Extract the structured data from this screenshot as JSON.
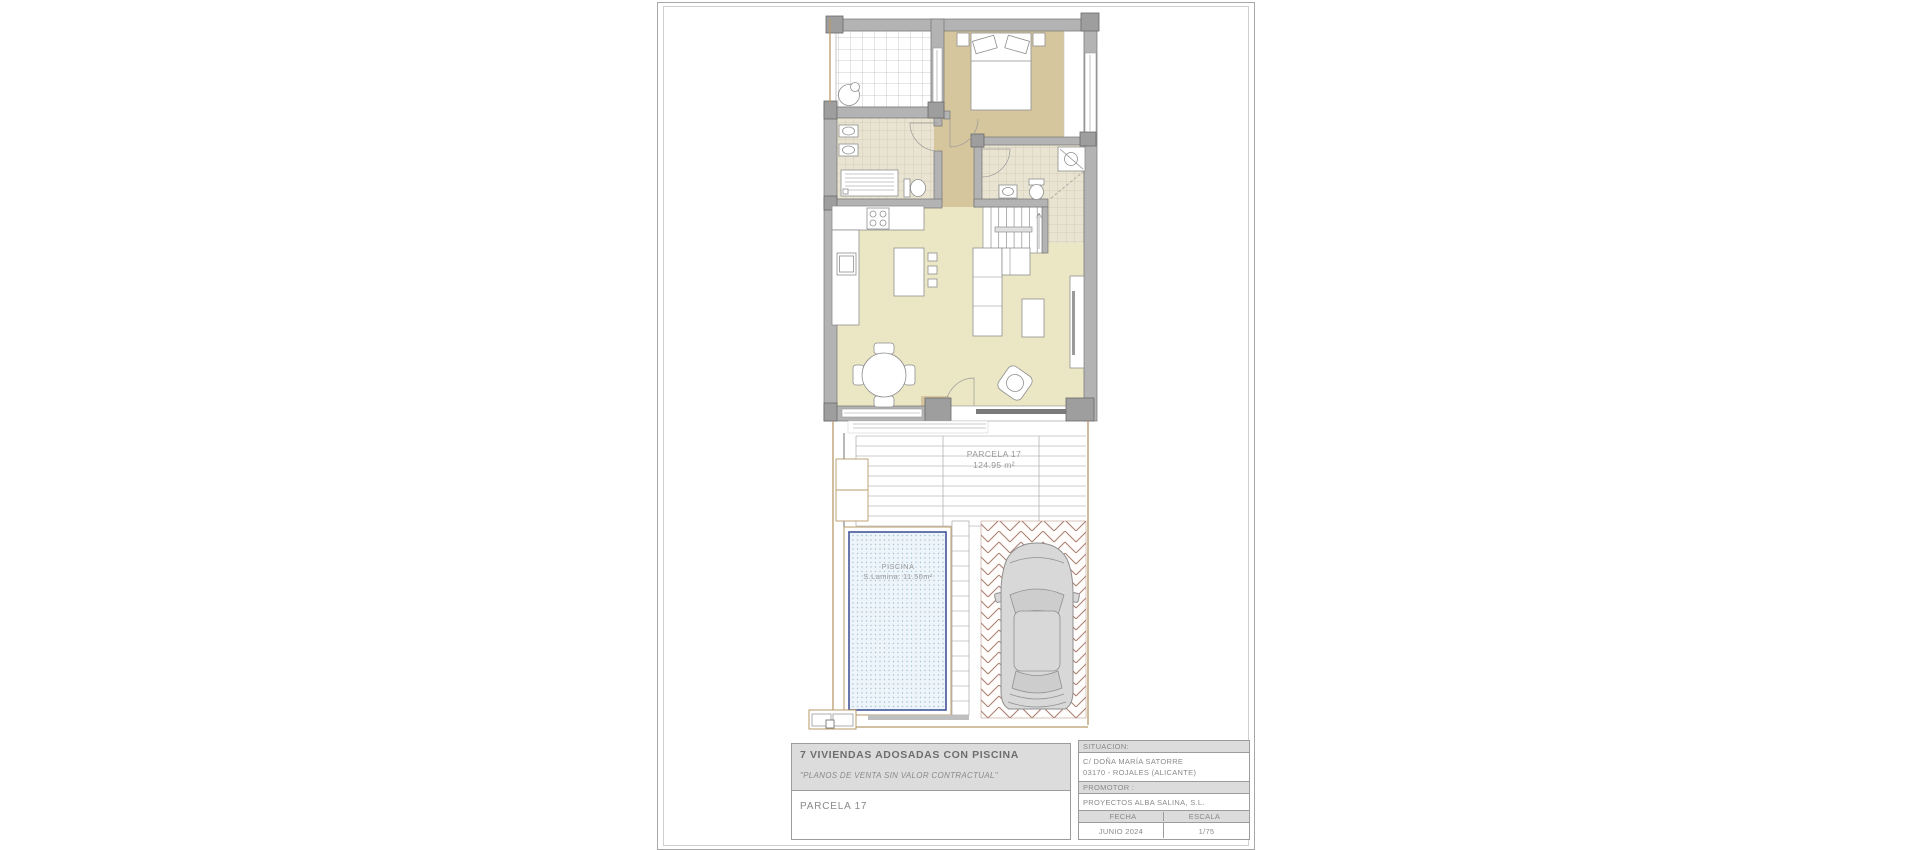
{
  "sheet": {
    "plan": {
      "parcela_label": "PARCELA 17",
      "parcela_area": "124.95 m²",
      "pool_label": "PISCINA",
      "pool_area": "S.Lamina: 11.50m²"
    },
    "title_block": {
      "project_title": "7 VIVIENDAS ADOSADAS CON PISCINA",
      "disclaimer": "\"PLANOS DE VENTA SIN VALOR CONTRACTUAL\"",
      "parcel_name": "PARCELA 17",
      "situacion": {
        "label": "SITUACION:",
        "address_line1": "C/ DOÑA MARÍA SATORRE",
        "address_line2": "03170 - ROJALES (ALICANTE)"
      },
      "promotor": {
        "label": "PROMOTOR :",
        "name": "PROYECTOS ALBA SALINA, S.L."
      },
      "fecha": {
        "label": "FECHA",
        "value": "JUNIO 2024"
      },
      "escala": {
        "label": "ESCALA",
        "value": "1/75"
      }
    },
    "colors": {
      "wall_gray": "#b3b3b3",
      "pier_gray": "#9e9e9e",
      "bedroom_floor_tan": "#d6c69d",
      "living_floor_pale": "#ebe6c4",
      "bath_tile": "#e9e3d1",
      "pool_fill": "#edf4fa",
      "pool_border_blue": "#44549c",
      "paving_line_brown": "#ab7d70",
      "boundary_tan": "#b89a6a",
      "title_band_gray": "#dcdcdc",
      "text_gray": "#8a8a8a"
    }
  }
}
